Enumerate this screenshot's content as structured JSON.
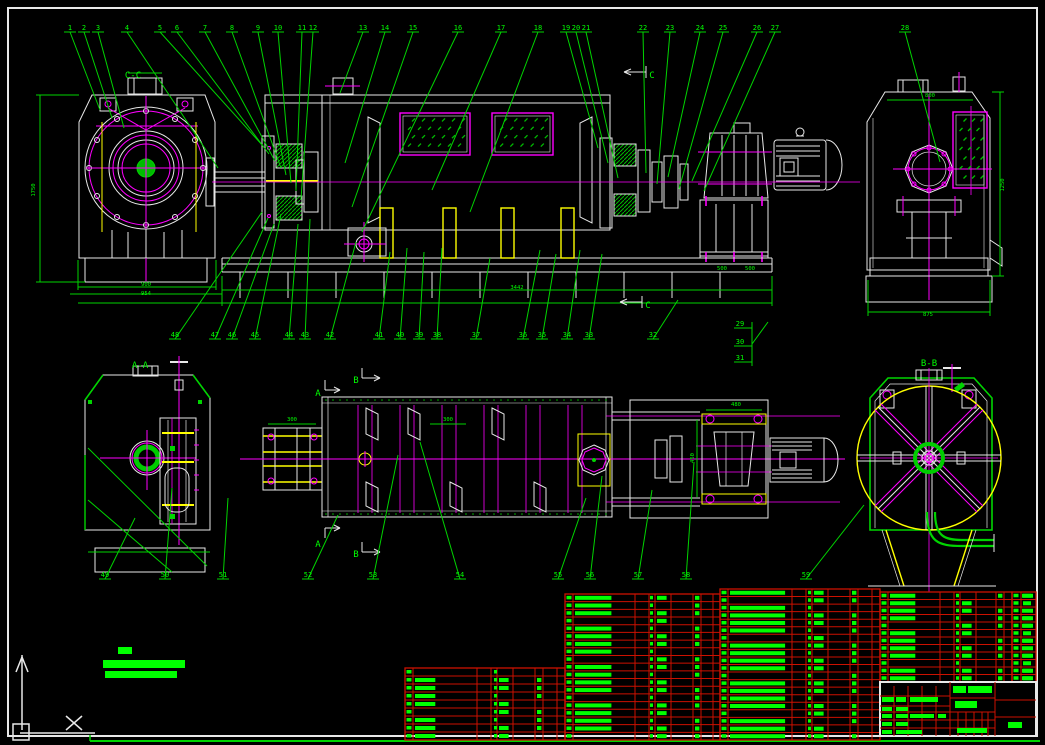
{
  "drawing": {
    "type": "cad-assembly-drawing",
    "background": "#000000",
    "colors": {
      "line_white": "#e8e8e8",
      "line_green": "#00d400",
      "text_green": "#00ff00",
      "magenta": "#ff00ff",
      "yellow": "#ffff00",
      "table_red": "#cc1100",
      "hatch_green": "#00bb00"
    },
    "section_labels": [
      {
        "t": "C-C",
        "x": 133,
        "y": 78
      },
      {
        "t": "C",
        "x": 652,
        "y": 78
      },
      {
        "t": "C",
        "x": 648,
        "y": 308
      },
      {
        "t": "A-A",
        "x": 140,
        "y": 368
      },
      {
        "t": "B-B",
        "x": 929,
        "y": 366
      },
      {
        "t": "A",
        "x": 318,
        "y": 396
      },
      {
        "t": "B",
        "x": 356,
        "y": 383
      },
      {
        "t": "A",
        "x": 318,
        "y": 547
      },
      {
        "t": "B",
        "x": 356,
        "y": 557
      }
    ],
    "callouts": {
      "top_y": 30,
      "top": [
        {
          "n": "1",
          "x": 70,
          "tx": 100,
          "ty": 110
        },
        {
          "n": "2",
          "x": 84,
          "tx": 112,
          "ty": 118
        },
        {
          "n": "3",
          "x": 98,
          "tx": 124,
          "ty": 128
        },
        {
          "n": "4",
          "x": 127,
          "tx": 218,
          "ty": 168
        },
        {
          "n": "5",
          "x": 160,
          "tx": 263,
          "ty": 146
        },
        {
          "n": "6",
          "x": 177,
          "tx": 269,
          "ty": 154
        },
        {
          "n": "7",
          "x": 205,
          "tx": 275,
          "ty": 161
        },
        {
          "n": "8",
          "x": 232,
          "tx": 281,
          "ty": 168
        },
        {
          "n": "9",
          "x": 258,
          "tx": 286,
          "ty": 175
        },
        {
          "n": "10",
          "x": 278,
          "tx": 291,
          "ty": 183
        },
        {
          "n": "11",
          "x": 302,
          "tx": 296,
          "ty": 191
        },
        {
          "n": "12",
          "x": 313,
          "tx": 301,
          "ty": 199
        },
        {
          "n": "13",
          "x": 363,
          "tx": 340,
          "ty": 93
        },
        {
          "n": "14",
          "x": 385,
          "tx": 345,
          "ty": 163
        },
        {
          "n": "15",
          "x": 413,
          "tx": 352,
          "ty": 207
        },
        {
          "n": "16",
          "x": 458,
          "tx": 362,
          "ty": 232
        },
        {
          "n": "17",
          "x": 501,
          "tx": 432,
          "ty": 190
        },
        {
          "n": "18",
          "x": 538,
          "tx": 470,
          "ty": 212
        },
        {
          "n": "19",
          "x": 566,
          "tx": 598,
          "ty": 148
        },
        {
          "n": "20",
          "x": 576,
          "tx": 608,
          "ty": 163
        },
        {
          "n": "21",
          "x": 586,
          "tx": 618,
          "ty": 178
        },
        {
          "n": "22",
          "x": 643,
          "tx": 646,
          "ty": 173
        },
        {
          "n": "23",
          "x": 670,
          "tx": 657,
          "ty": 184
        },
        {
          "n": "24",
          "x": 700,
          "tx": 668,
          "ty": 177
        },
        {
          "n": "25",
          "x": 723,
          "tx": 679,
          "ty": 189
        },
        {
          "n": "26",
          "x": 757,
          "tx": 692,
          "ty": 181
        },
        {
          "n": "27",
          "x": 775,
          "tx": 704,
          "ty": 191
        },
        {
          "n": "28",
          "x": 905,
          "tx": 940,
          "ty": 162
        }
      ],
      "mid_y": 337,
      "mid": [
        {
          "n": "48",
          "x": 175,
          "tx": 262,
          "ty": 212
        },
        {
          "n": "47",
          "x": 215,
          "tx": 268,
          "ty": 218
        },
        {
          "n": "46",
          "x": 232,
          "tx": 274,
          "ty": 224
        },
        {
          "n": "45",
          "x": 255,
          "tx": 281,
          "ty": 214
        },
        {
          "n": "44",
          "x": 289,
          "tx": 298,
          "ty": 224
        },
        {
          "n": "43",
          "x": 305,
          "tx": 310,
          "ty": 219
        },
        {
          "n": "42",
          "x": 330,
          "tx": 356,
          "ty": 242
        },
        {
          "n": "41",
          "x": 379,
          "tx": 390,
          "ty": 252
        },
        {
          "n": "40",
          "x": 400,
          "tx": 407,
          "ty": 248
        },
        {
          "n": "39",
          "x": 419,
          "tx": 424,
          "ty": 252
        },
        {
          "n": "38",
          "x": 437,
          "tx": 442,
          "ty": 248
        },
        {
          "n": "37",
          "x": 476,
          "tx": 490,
          "ty": 258
        },
        {
          "n": "36",
          "x": 523,
          "tx": 540,
          "ty": 250
        },
        {
          "n": "35",
          "x": 542,
          "tx": 556,
          "ty": 254
        },
        {
          "n": "34",
          "x": 567,
          "tx": 580,
          "ty": 250
        },
        {
          "n": "33",
          "x": 589,
          "tx": 602,
          "ty": 254
        },
        {
          "n": "32",
          "x": 653,
          "tx": 678,
          "ty": 300
        }
      ],
      "stack": [
        {
          "n": "29",
          "x": 740,
          "y": 326
        },
        {
          "n": "30",
          "x": 740,
          "y": 344
        },
        {
          "n": "31",
          "x": 740,
          "y": 360
        }
      ],
      "bottom_y": 577,
      "bottom": [
        {
          "n": "49",
          "x": 105,
          "tx": 135,
          "ty": 518
        },
        {
          "n": "50",
          "x": 165,
          "tx": 172,
          "ty": 488
        },
        {
          "n": "51",
          "x": 223,
          "tx": 228,
          "ty": 498
        },
        {
          "n": "52",
          "x": 308,
          "tx": 338,
          "ty": 515
        },
        {
          "n": "53",
          "x": 373,
          "tx": 398,
          "ty": 455
        },
        {
          "n": "54",
          "x": 460,
          "tx": 420,
          "ty": 442
        },
        {
          "n": "55",
          "x": 558,
          "tx": 586,
          "ty": 498
        },
        {
          "n": "56",
          "x": 590,
          "tx": 602,
          "ty": 476
        },
        {
          "n": "57",
          "x": 638,
          "tx": 652,
          "ty": 490
        },
        {
          "n": "58",
          "x": 686,
          "tx": 694,
          "ty": 462
        },
        {
          "n": "59",
          "x": 806,
          "tx": 864,
          "ty": 505
        }
      ],
      "bracket_lines": [
        [
          746,
          328,
          752,
          328
        ],
        [
          746,
          346,
          752,
          346
        ],
        [
          746,
          362,
          752,
          362
        ],
        [
          752,
          322,
          752,
          366
        ],
        [
          752,
          344,
          768,
          322
        ]
      ]
    },
    "dimensions": [
      {
        "t": "1750",
        "x": 35,
        "y": 190,
        "r": -90
      },
      {
        "t": "900",
        "x": 146,
        "y": 286,
        "r": 0
      },
      {
        "t": "954",
        "x": 146,
        "y": 295,
        "r": 0
      },
      {
        "t": "800",
        "x": 930,
        "y": 97,
        "r": 0
      },
      {
        "t": "1250",
        "x": 1004,
        "y": 185,
        "r": -90
      },
      {
        "t": "875",
        "x": 928,
        "y": 316,
        "r": 0
      },
      {
        "t": "3442",
        "x": 517,
        "y": 289,
        "r": 0
      },
      {
        "t": "500",
        "x": 722,
        "y": 270,
        "r": 0
      },
      {
        "t": "500",
        "x": 750,
        "y": 270,
        "r": 0
      },
      {
        "t": "480",
        "x": 736,
        "y": 406,
        "r": 0
      },
      {
        "t": "450",
        "x": 694,
        "y": 458,
        "r": -90
      },
      {
        "t": "300",
        "x": 292,
        "y": 421,
        "r": 0
      },
      {
        "t": "300",
        "x": 448,
        "y": 421,
        "r": 0
      }
    ],
    "screens": [
      {
        "x": 400,
        "y": 113,
        "w": 70,
        "h": 42,
        "rows": 4,
        "cols": 6
      },
      {
        "x": 492,
        "y": 113,
        "w": 61,
        "h": 42,
        "rows": 4,
        "cols": 5
      },
      {
        "x": 953,
        "y": 112,
        "w": 34,
        "h": 76,
        "rows": 7,
        "cols": 3
      }
    ],
    "dot_rows": [
      {
        "x1": 326,
        "x2": 608,
        "y": 400,
        "step": 7
      },
      {
        "x1": 326,
        "x2": 608,
        "y": 514,
        "step": 7
      }
    ],
    "tech_note_bars": [
      [
        118,
        647,
        14,
        7
      ],
      [
        103,
        660,
        82,
        8
      ],
      [
        105,
        671,
        72,
        7
      ]
    ],
    "bom": {
      "sections": [
        {
          "x": 405,
          "y": 668,
          "w": 160,
          "h": 72,
          "rows": 9,
          "cols": [
            0,
            8,
            72,
            86,
            92,
            108,
            130,
            138,
            152,
            160
          ],
          "qty": 89
        },
        {
          "x": 565,
          "y": 594,
          "w": 155,
          "h": 146,
          "rows": 19,
          "cols": [
            0,
            8,
            70,
            84,
            90,
            106,
            128,
            136,
            148,
            155
          ],
          "qty": 85
        },
        {
          "x": 720,
          "y": 589,
          "w": 160,
          "h": 151,
          "rows": 20,
          "cols": [
            0,
            8,
            72,
            86,
            92,
            108,
            130,
            138,
            152,
            160
          ],
          "qty": 88
        },
        {
          "x": 880,
          "y": 592,
          "w": 132,
          "h": 90,
          "rows": 12,
          "cols": [
            0,
            8,
            60,
            74,
            80,
            96,
            116,
            124,
            132
          ],
          "qty": 76
        },
        {
          "x": 1012,
          "y": 592,
          "w": 24,
          "h": 90,
          "rows": 12,
          "cols": [
            0,
            9,
            24
          ],
          "qty": -1
        }
      ],
      "title_block": {
        "x": 880,
        "y": 682,
        "w": 156,
        "h": 54,
        "red_v": [
          [
            950,
            682,
            736
          ],
          [
            995,
            682,
            736
          ],
          [
            894,
            686,
            736
          ],
          [
            908,
            686,
            736
          ],
          [
            922,
            686,
            736
          ],
          [
            936,
            686,
            736
          ],
          [
            958,
            712,
            736
          ],
          [
            966,
            712,
            736
          ],
          [
            974,
            712,
            736
          ],
          [
            982,
            712,
            736
          ],
          [
            988,
            712,
            736
          ]
        ],
        "red_h": [
          [
            880,
            950,
            696
          ],
          [
            880,
            950,
            706
          ],
          [
            880,
            950,
            712
          ],
          [
            880,
            950,
            720
          ],
          [
            880,
            950,
            728
          ],
          [
            950,
            995,
            698
          ],
          [
            950,
            995,
            712
          ],
          [
            950,
            995,
            720
          ],
          [
            950,
            995,
            728
          ],
          [
            995,
            1036,
            700
          ],
          [
            995,
            1036,
            717
          ]
        ],
        "green_bars": [
          [
            953,
            686,
            13,
            7
          ],
          [
            968,
            686,
            24,
            7
          ],
          [
            955,
            701,
            22,
            7
          ],
          [
            957,
            728,
            30,
            5
          ],
          [
            1008,
            722,
            14,
            6
          ],
          [
            882,
            697,
            12,
            5
          ],
          [
            896,
            697,
            10,
            5
          ],
          [
            910,
            697,
            16,
            5
          ],
          [
            926,
            697,
            12,
            5
          ],
          [
            882,
            707,
            10,
            4
          ],
          [
            896,
            707,
            12,
            4
          ],
          [
            882,
            714,
            10,
            4
          ],
          [
            896,
            714,
            12,
            4
          ],
          [
            910,
            714,
            14,
            4
          ],
          [
            924,
            714,
            10,
            4
          ],
          [
            938,
            714,
            8,
            4
          ],
          [
            882,
            722,
            10,
            4
          ],
          [
            896,
            722,
            12,
            4
          ],
          [
            882,
            730,
            10,
            4
          ],
          [
            896,
            730,
            14,
            4
          ],
          [
            910,
            730,
            12,
            4
          ]
        ]
      }
    }
  }
}
